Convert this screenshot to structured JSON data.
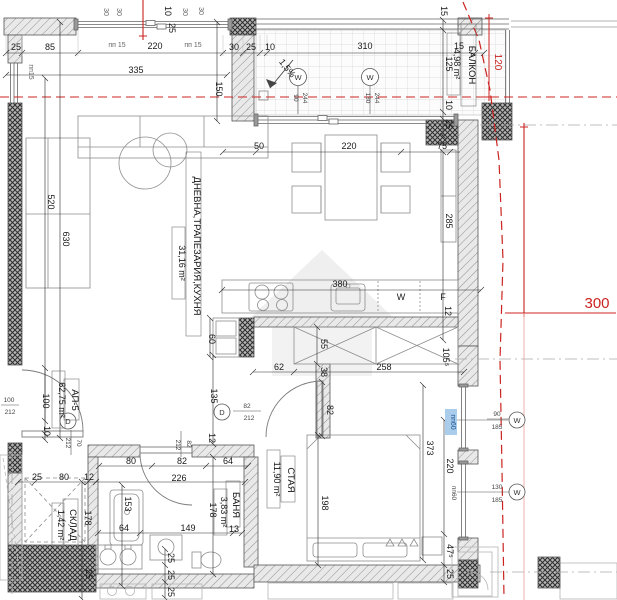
{
  "apartment": {
    "id": "АП-5",
    "area": "62,75 m²"
  },
  "rooms": {
    "living": {
      "name": "ДНЕВНА,ТРАПЕЗАРИЯ,КУХНЯ",
      "area": "31,16 m²"
    },
    "balcony": {
      "name": "БАЛКОН",
      "area": "4,98 m²"
    },
    "bedroom": {
      "name": "СТАЯ",
      "area": "11,90 m²"
    },
    "bath": {
      "name": "БАНЯ",
      "area": "3,83 m²"
    },
    "storage": {
      "name": "СКЛАД",
      "area": "1,42 m²"
    }
  },
  "annotations": {
    "slope": "1,5%",
    "red_offset_120": "120",
    "red_offset_300": "300",
    "washer": "W",
    "fridge": "F",
    "window_marker": "W",
    "door_marker": "D",
    "pp15_top_a": "пп 15",
    "pp15_top_b": "пп 15",
    "pp15_left": "пп15",
    "pp60_blue": "пп60",
    "pp60_gray": "пп60"
  },
  "openings": {
    "balcony_win1": {
      "w": "90",
      "h": "244"
    },
    "balcony_win2": {
      "w": "130",
      "h": "244"
    },
    "bedroom_win1": {
      "w": "90",
      "h": "185"
    },
    "bedroom_win2": {
      "w": "130",
      "h": "185"
    },
    "entry_door": {
      "w": "70",
      "h": "212"
    },
    "hall_door": {
      "w": "82",
      "h": "212"
    },
    "bedroom_door": {
      "w": "82",
      "h": "212"
    },
    "edge_door": {
      "w": "100",
      "h": "212"
    }
  },
  "dims": {
    "top": [
      "25",
      "85",
      "220",
      "30",
      "25",
      "10",
      "310",
      "15",
      "335",
      "150"
    ],
    "top_small_rot": [
      "30",
      "30",
      "30",
      "30",
      "10",
      "25"
    ],
    "balcony_right": [
      "15",
      "125",
      "10",
      "25"
    ],
    "living": [
      "50",
      "220",
      "75",
      "285",
      "520",
      "630"
    ],
    "kitchen": [
      "380",
      "12",
      "60",
      "62",
      "258",
      "38",
      "55",
      "105⁵"
    ],
    "hall": [
      "100",
      "10",
      "135",
      "12",
      "80",
      "82",
      "64",
      "25",
      "80",
      "12",
      "226"
    ],
    "bath_storage": [
      "178",
      "153",
      "64",
      "149",
      "13",
      "178",
      "25",
      "25",
      "25",
      "25"
    ],
    "bedroom": [
      "82",
      "373",
      "198",
      "220",
      "47⁵",
      "25"
    ]
  }
}
